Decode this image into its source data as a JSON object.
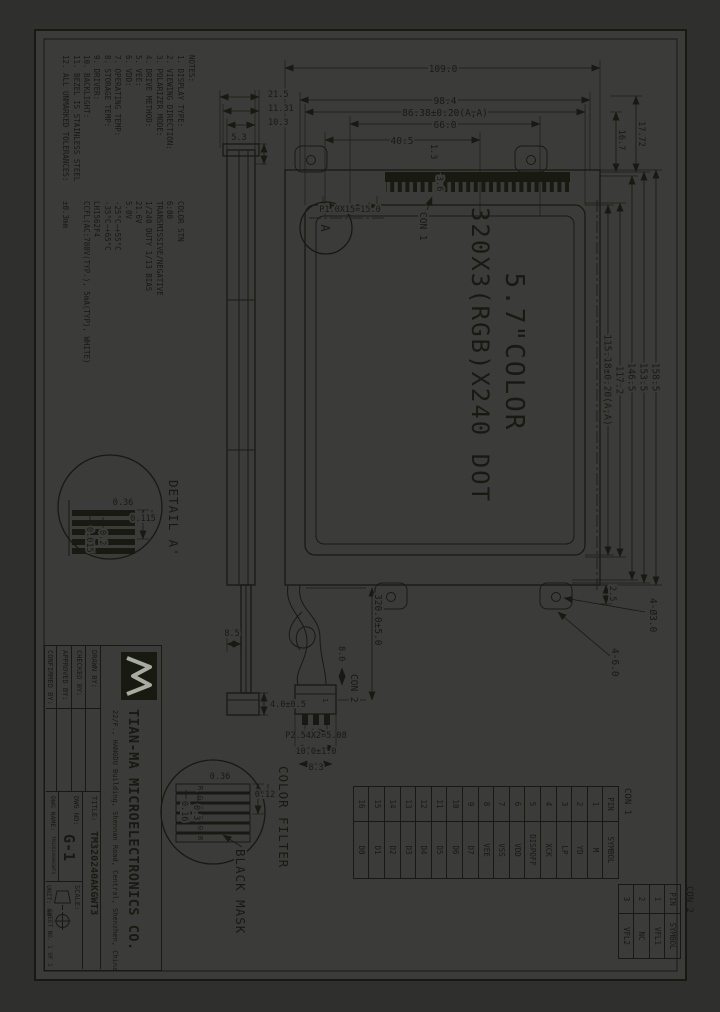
{
  "colors": {
    "background": "#2f2f2d",
    "sheet": "#3b3b39",
    "line": "#181a12"
  },
  "center": {
    "line1": "5.7\"COLOR",
    "line2": "320X3(RGB)X240 DOT"
  },
  "notes": {
    "heading": "NOTES:",
    "items": [
      {
        "label": "1. DISPLAY TYPE:",
        "value": "COLOR STN"
      },
      {
        "label": "2. VIEWING DIRECTION:",
        "value": "6:00"
      },
      {
        "label": "3. POLARIZER MODE:",
        "value": "TRANSMISSIVE/NEGATIVE"
      },
      {
        "label": "4. DRIVE METHOD:",
        "value": "1/240 DUTY  1/13 BIAS"
      },
      {
        "label": "5. VEE:",
        "value": "21.6V"
      },
      {
        "label": "6. VDD:",
        "value": "5.0V"
      },
      {
        "label": "7. OPERATING TEMP:",
        "value": "-25°C~+55°C"
      },
      {
        "label": "8. STORAGE TEMP:",
        "value": "-35°C~+65°C"
      },
      {
        "label": "9. DRIVER:",
        "value": "LH1562F4"
      },
      {
        "label": "10. BACKLIGHT:",
        "value": "CCFL(AC:780V(TYP.), 5mA(TYP), WHITE)"
      },
      {
        "label": "11. BEZEL IS STAINLESS STEEL",
        "value": ""
      },
      {
        "label": "12. ALL UNMARKED TOLERANCES:",
        "value": "±0.3mm"
      }
    ]
  },
  "dims": {
    "w_total": "158.5",
    "w2": "153.5",
    "w3": "146.5",
    "w4": "117.2",
    "w_aa": "115.18±0.20(A,A)",
    "off1": "16.7",
    "off2": "17.72",
    "h_total": "109.0",
    "h2": "98.4",
    "h_aa": "86.38±0.20(A,A)",
    "h3": "66.0",
    "h4": "40.5",
    "comb_off": "1.3",
    "comb_w": "3.6",
    "comb_pitch": "P1.0X15=15.0",
    "hole_off": "2.5",
    "holes": "4-Ø3.0",
    "tabs": "4-6.0",
    "cable_len": "320.0±5.0",
    "con2_off": "8.0",
    "con2_pitch": "P2.54X2=5.08",
    "con2_w": "10.0±1.0",
    "con2_w2": "8.3",
    "cap_w": "4.0±0.5",
    "lip": "5.3",
    "lamp": "8.5",
    "t1": "10.3",
    "t2": "11.31",
    "t3": "21.5"
  },
  "labels": {
    "con1": "CON 1",
    "con2": "CON 2",
    "detail_a": "DETAIL A'",
    "detail_marker": "A",
    "color_filter": "COLOR FILTER",
    "black_mask": "BLACK MASK",
    "pin1": "1",
    "pin3": "3"
  },
  "detail_a": {
    "d1": "0.36",
    "d2": "0.115",
    "d3": "0.2",
    "d4": "0.015"
  },
  "color_filter": {
    "d1": "0.36",
    "d2": "0.12",
    "d3": "0.3",
    "d4": "0.16",
    "rgb": [
      "R",
      "G",
      "B",
      "R",
      "G",
      "B"
    ]
  },
  "con1": {
    "title": "CON 1",
    "pin_h": "PIN",
    "sym_h": "SYMBOL",
    "rows": [
      [
        "1",
        "M"
      ],
      [
        "2",
        "YD"
      ],
      [
        "3",
        "LP"
      ],
      [
        "4",
        "XCK"
      ],
      [
        "5",
        "DISPOFF"
      ],
      [
        "6",
        "VDD"
      ],
      [
        "7",
        "VSS"
      ],
      [
        "8",
        "VEE"
      ],
      [
        "9",
        "D7"
      ],
      [
        "10",
        "D6"
      ],
      [
        "11",
        "D5"
      ],
      [
        "12",
        "D4"
      ],
      [
        "13",
        "D3"
      ],
      [
        "14",
        "D2"
      ],
      [
        "15",
        "D1"
      ],
      [
        "16",
        "D0"
      ]
    ]
  },
  "con2": {
    "title": "CON 2",
    "pin_h": "PIN",
    "sym_h": "SYMBOL",
    "rows": [
      [
        "1",
        "VFL1"
      ],
      [
        "2",
        "NC"
      ],
      [
        "3",
        "VFL2"
      ]
    ]
  },
  "title_block": {
    "company": "TIAN-MA MICROELECTRONICS CO.",
    "address": "22/F., HANGDU Building, Shennan Road, Central, Shenzhen, China",
    "drawn": "DRAWN BY:",
    "checked": "CHECKED BY:",
    "approved": "APPROVED BY:",
    "confirmed": "CONFIRMED BY:",
    "title_label": "TITLE:",
    "title_value": "TM320240AKGWT3",
    "dwg_no_label": "DWG NO:",
    "dwg_no_value": "G-1",
    "dwg_name_label": "DWG NAME:",
    "dwg_name_value": "TM320240AKGWT3",
    "scale_label": "SCALE:",
    "unit_label": "UNIT:",
    "unit_value": "mm",
    "sheet_label": "SHEET NO. 1 OF 1"
  }
}
